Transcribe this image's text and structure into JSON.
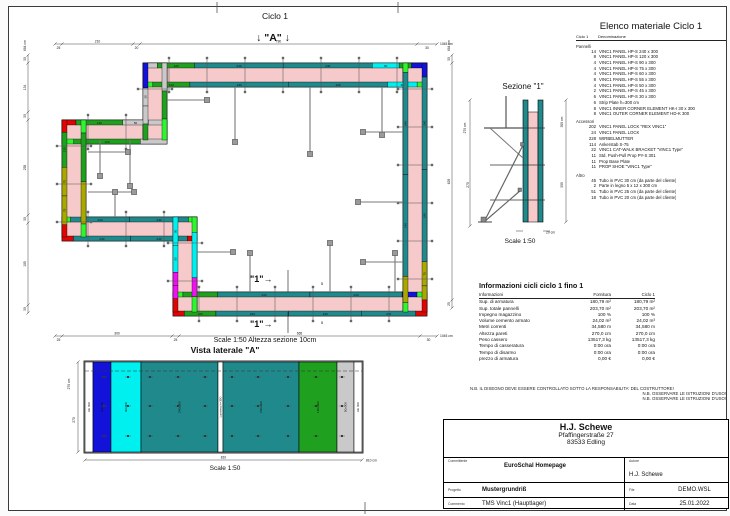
{
  "colors": {
    "teal": "#20898c",
    "green": "#1fa01f",
    "light_green": "#2ef52e",
    "blue": "#1212d8",
    "cyan": "#00f0f0",
    "red": "#e00505",
    "magenta": "#f011f0",
    "olive": "#a8a800",
    "gray": "#c9c9c9",
    "white": "#ffffff",
    "pink": "#f6caca",
    "prop": "#787878",
    "dim": "#303030"
  },
  "plan": {
    "title": "Ciclo 1",
    "marker_a": "↓ \"A\" ↓",
    "marker_1": "\"1\"→",
    "scale_note": "Scale 1:50   Altezza sezione 10cm",
    "prop_label": "5",
    "panel_labels": {
      "240": "240",
      "120": "120",
      "130": "130",
      "90": "90",
      "75": "75",
      "50": "50",
      "45": "45",
      "30": "30"
    },
    "dims": {
      "top": [
        "25",
        "210",
        "20",
        "780",
        "30"
      ],
      "top_total": "1045 cm",
      "bottom": [
        "25",
        "300",
        "25",
        "665",
        "30"
      ],
      "bottom_total": "1045 cm",
      "left": [
        "30",
        "134",
        "30",
        "255",
        "30",
        "195",
        "30"
      ],
      "left_total": "684 cm",
      "right": [
        "30",
        "629",
        "25"
      ],
      "right_total": "684 cm"
    }
  },
  "vista": {
    "title": "Vista laterale \"A\"",
    "scale": "Scale 1:50",
    "dim_left_total": "270 cm",
    "dim_left_seg": "270",
    "dim_bottom_seg": "810",
    "dim_bottom_total": "810 cm",
    "panels": [
      {
        "label": "AE 300",
        "color": "white",
        "w": 8
      },
      {
        "label": "60x300",
        "color": "blue",
        "w": 18
      },
      {
        "label": "90x300",
        "color": "cyan",
        "w": 30
      },
      {
        "label": "240x300",
        "color": "teal",
        "w": 77
      },
      {
        "label": "Lamiera h=300",
        "color": "white",
        "w": 5
      },
      {
        "label": "240x300",
        "color": "teal",
        "w": 76
      },
      {
        "label": "120x300",
        "color": "green",
        "w": 38
      },
      {
        "label": "50x300",
        "color": "gray",
        "w": 17
      },
      {
        "label": "AE 300",
        "color": "white",
        "w": 8
      }
    ]
  },
  "sezione": {
    "title": "Sezione \"1\"",
    "scale": "Scale 1:50",
    "dim_left_total": "270 cm",
    "dim_left_seg": "270",
    "dim_right_total": "300 cm",
    "dim_right_seg": "300",
    "thickness": "20 cm"
  },
  "elenco": {
    "title": "Elenco materiale  Ciclo 1",
    "col_qty": "Ciclo 1",
    "col_name": "Denominazione",
    "groups": [
      {
        "name": "Pannelli",
        "rows": [
          {
            "qty": "14",
            "desc": "VINC1 PANEL HP-S 240 x 300"
          },
          {
            "qty": "8",
            "desc": "VINC1 PANEL HP-S 120 x 300"
          },
          {
            "qty": "4",
            "desc": "VINC1 PANEL HP-S 90 x 300"
          },
          {
            "qty": "4",
            "desc": "VINC1 PANEL HP-S 75 x 300"
          },
          {
            "qty": "4",
            "desc": "VINC1 PANEL HP-S 60 x 300"
          },
          {
            "qty": "8",
            "desc": "VINC1 PANEL HP-S 55 x 300"
          },
          {
            "qty": "4",
            "desc": "VINC1 PANEL HP-S 50 x 300"
          },
          {
            "qty": "2",
            "desc": "VINC1 PANEL HP-S 45 x 300"
          },
          {
            "qty": "6",
            "desc": "VINC1 PANEL HP-S 30 x 300"
          },
          {
            "qty": "6",
            "desc": "Strip Plate h=300 cm"
          },
          {
            "qty": "8",
            "desc": "VINC1 INNER CORNER ELEMENT HK-I 30 x 300"
          },
          {
            "qty": "8",
            "desc": "VINC1 OUTER CORNER ELEMENT HD-K 300"
          }
        ]
      },
      {
        "name": "Accessori",
        "rows": [
          {
            "qty": "202",
            "desc": "VINC1 PANEL LOCK \"REX VINC1\""
          },
          {
            "qty": "24",
            "desc": "VINC1 PANEL LOCK"
          },
          {
            "qty": "228",
            "desc": "WIRBELMUTTER"
          },
          {
            "qty": "114",
            "desc": "Ankerstab S-75"
          },
          {
            "qty": "22",
            "desc": "VINC1 CAT-WALK BRACKET \"VINC1 Type\""
          },
          {
            "qty": "11",
            "desc": "Std. Push-Pull Prop PY-S 301"
          },
          {
            "qty": "11",
            "desc": "Prop Base Plate"
          },
          {
            "qty": "11",
            "desc": "PROP SHOE \"VINC1 Type\""
          }
        ]
      },
      {
        "name": "Altro",
        "rows": [
          {
            "qty": "45",
            "desc": "Tubo in PVC 30 cm (da parte del cliente)"
          },
          {
            "qty": "2",
            "desc": "Parte in legno 5 x 12 x 300 cm"
          },
          {
            "qty": "51",
            "desc": "Tubo in PVC 25 cm (da parte del cliente)"
          },
          {
            "qty": "18",
            "desc": "Tubo in PVC 20 cm (da parte del cliente)"
          }
        ]
      }
    ]
  },
  "info": {
    "title": "Informazioni cicli  ciclo 1 fino 1",
    "headers": [
      "Informazioni",
      "Fornitura",
      "Ciclo 1"
    ],
    "rows": [
      [
        "Sup. di armatura",
        "180,79 m²",
        "180,79 m²"
      ],
      [
        "Sup. totale pannelli",
        "203,70 m²",
        "203,70 m²"
      ],
      [
        "Impegno magazzino",
        "100 %",
        "100 %"
      ],
      [
        "Volume cemento armato",
        "24,02 m³",
        "24,02 m³"
      ],
      [
        "Metri correnti",
        "34,580 m",
        "34,580 m"
      ],
      [
        "Altezza pareti",
        "270,0 cm",
        "270,0 cm"
      ],
      [
        "Peso cassero",
        "13517,3 kg",
        "13517,3 kg"
      ],
      [
        "Tempo di casseratura",
        "0:00 ora",
        "0:00 ora"
      ],
      [
        "Tempo di disarmo",
        "0:00 ora",
        "0:00 ora"
      ],
      [
        "prezzo di armatura",
        "0,00 €",
        "0,00 €"
      ]
    ]
  },
  "nb": [
    "N.B. IL DISEGNO DEVE ESSERE CONTROLLATO SOTTO LA RESPONSABILITA' DEL COSTRUTTORE!",
    "N.B. OSSERVARE LE ISTRUZIONI D'USO!",
    "N.B. OSSERVARE LE ISTRUZIONI D'USO!"
  ],
  "titleblock": {
    "company": "H.J. Schewe",
    "address1": "Pfaffingerstraße 27",
    "address2": "83533 Edling",
    "committente_label": "Committente",
    "committente": "EuroSchal Homepage",
    "autore_label": "Autore",
    "autore": "H.J. Schewe",
    "progetto_label": "Progetto",
    "progetto": "Mustergrundriß",
    "file_label": "File",
    "file": "DEMO.WSL",
    "commento_label": "Commento",
    "commento": "TMS Vinc1 (Hauptlager)",
    "data_label": "Data",
    "data": "25.01.2022"
  }
}
